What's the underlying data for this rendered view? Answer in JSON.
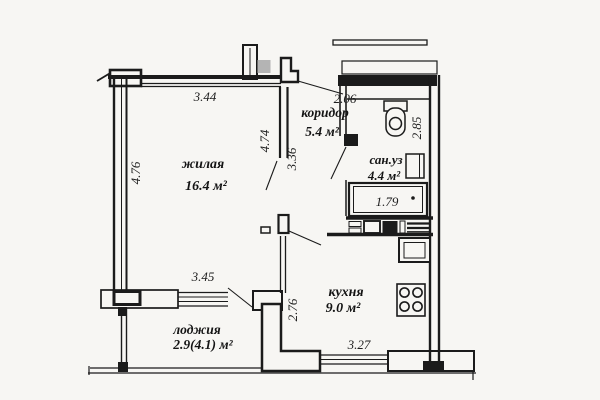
{
  "plan": {
    "type": "apartment-floor-plan",
    "rooms": {
      "living": {
        "name": "жилая",
        "area": "16.4 м²"
      },
      "corridor": {
        "name": "коридор",
        "area": "5.4 м²"
      },
      "bathroom": {
        "name": "сан.уз",
        "area": "4.4 м²"
      },
      "kitchen": {
        "name": "кухня",
        "area": "9.0 м²"
      },
      "loggia": {
        "name": "лоджия",
        "area": "2.9(4.1) м²"
      }
    },
    "dimensions": {
      "living_top_width": "3.44",
      "living_left_height": "4.76",
      "living_inner_wall": "4.74",
      "corridor_wall": "3.36",
      "corridor_top_width": "2.06",
      "bathroom_side_height": "2.85",
      "bathtub_length": "1.79",
      "loggia_top_width": "3.45",
      "kitchen_side_height": "2.76",
      "kitchen_bottom_width": "3.27"
    },
    "fixtures": [
      "toilet",
      "bathtub",
      "bathroom-cabinet",
      "kitchen-sink",
      "stove",
      "vent-shaft",
      "entry-door"
    ],
    "colors": {
      "line": "#1b1b1b",
      "paper": "#f7f6f3",
      "entry_door_gray": "#b4b4b4"
    }
  }
}
